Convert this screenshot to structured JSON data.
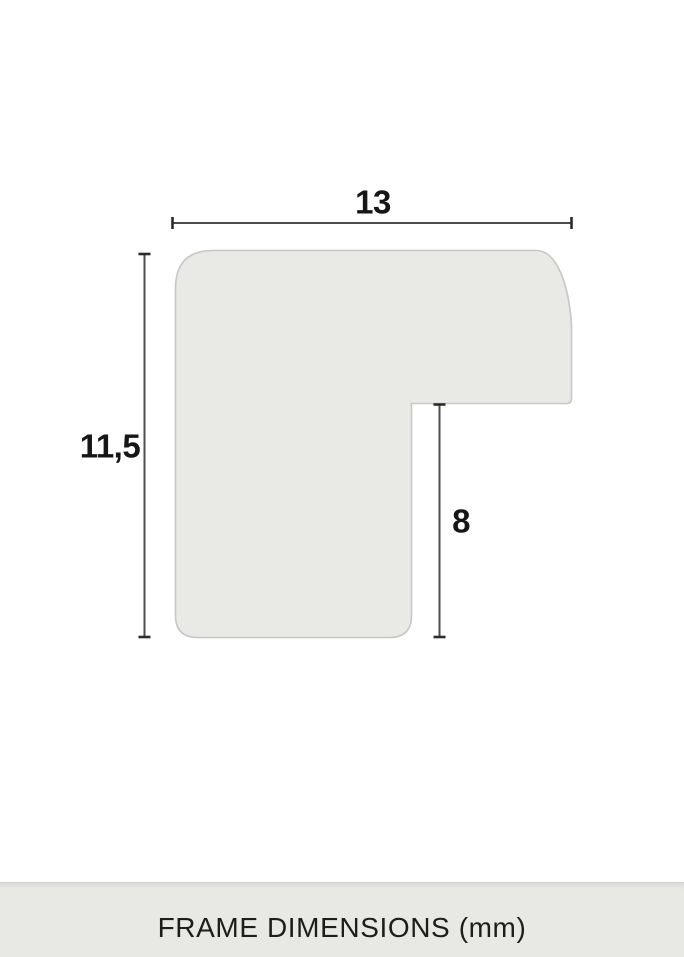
{
  "diagram": {
    "type": "frame-profile-cross-section",
    "width_label": "13",
    "height_label": "11,5",
    "depth_label": "8"
  },
  "footer": {
    "caption": "FRAME DIMENSIONS (mm)"
  },
  "colors": {
    "background": "#ffffff",
    "profile_fill": "#e9eae6",
    "profile_border": "#c7c8c4",
    "dimension_line": "#4d4d4d",
    "dimension_tick": "#2b2b2b",
    "label_text": "#161616",
    "footer_bg": "#e8e9e5",
    "footer_text": "#1d1d1b"
  }
}
